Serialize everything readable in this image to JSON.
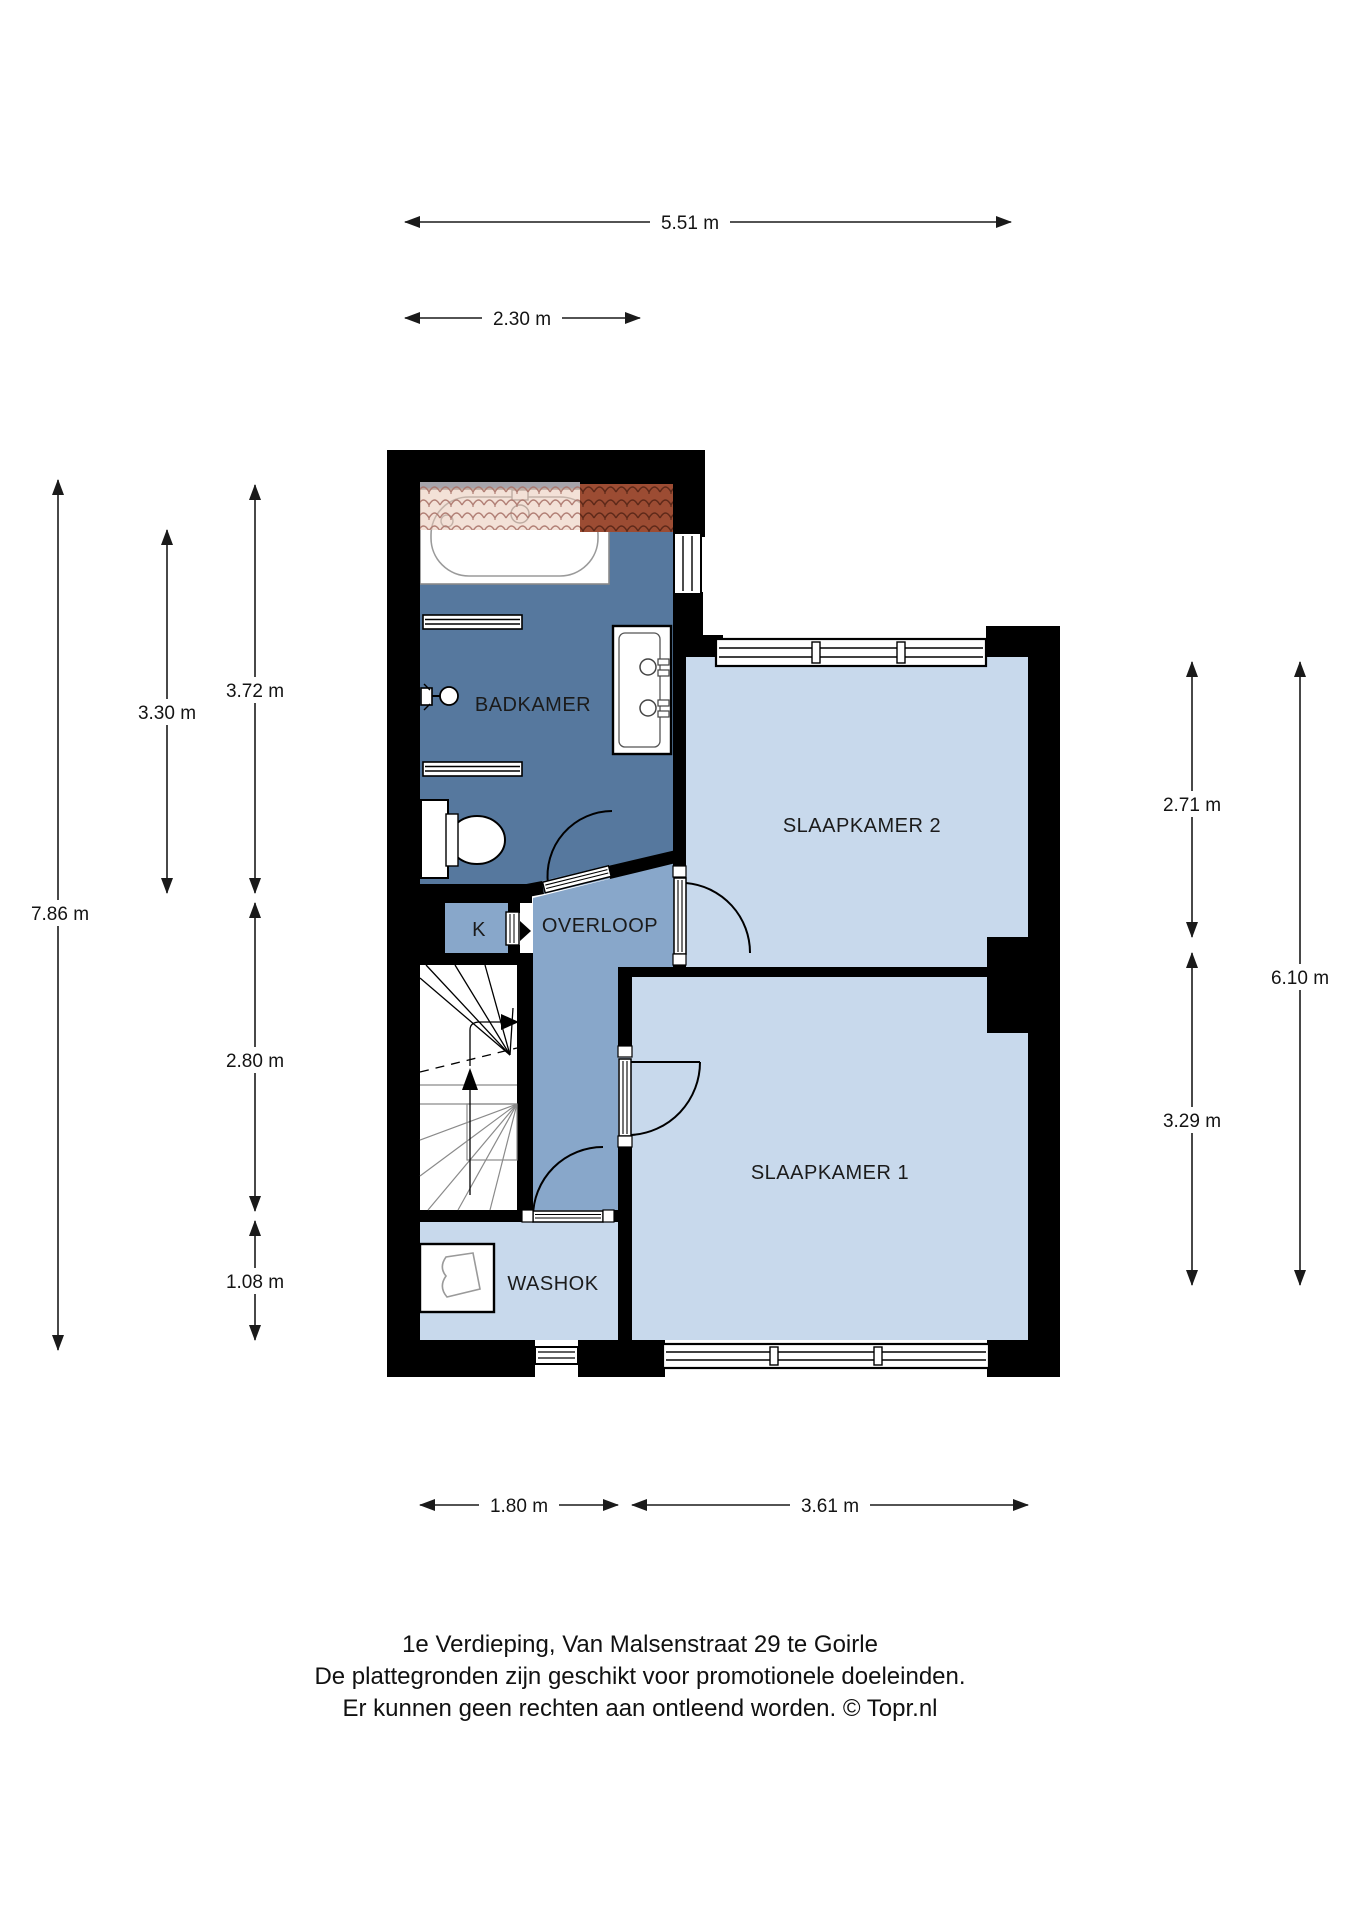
{
  "rooms": [
    {
      "id": "badkamer",
      "label": "BADKAMER"
    },
    {
      "id": "slaapkamer2",
      "label": "SLAAPKAMER 2"
    },
    {
      "id": "overloop",
      "label": "OVERLOOP"
    },
    {
      "id": "kast",
      "label": "K"
    },
    {
      "id": "slaapkamer1",
      "label": "SLAAPKAMER 1"
    },
    {
      "id": "washok",
      "label": "WASHOK"
    }
  ],
  "dimensions": [
    {
      "id": "top-total",
      "label": "5.51 m"
    },
    {
      "id": "top-badkamer",
      "label": "2.30 m"
    },
    {
      "id": "left-total",
      "label": "7.86 m"
    },
    {
      "id": "left-badkamer-inner",
      "label": "3.30 m"
    },
    {
      "id": "left-badkamer",
      "label": "3.72 m"
    },
    {
      "id": "left-trap",
      "label": "2.80 m"
    },
    {
      "id": "left-washok",
      "label": "1.08 m"
    },
    {
      "id": "right-slaapkamer2",
      "label": "2.71 m"
    },
    {
      "id": "right-slaapkamer1",
      "label": "3.29 m"
    },
    {
      "id": "right-total",
      "label": "6.10 m"
    },
    {
      "id": "bottom-washok",
      "label": "1.80 m"
    },
    {
      "id": "bottom-slaapkamer1",
      "label": "3.61 m"
    }
  ],
  "footer": {
    "line1": "1e Verdieping, Van Malsenstraat 29 te Goirle",
    "line2": "De plattegronden zijn geschikt voor promotionele doeleinden.",
    "line3": "Er kunnen geen rechten aan ontleend worden. © Topr.nl"
  },
  "colors": {
    "bathroom_floor": "#56789e",
    "landing_floor": "#88a7ca",
    "bedroom_floor": "#c8d9ec",
    "laundry_floor": "#c8d9ec",
    "wall": "#000000",
    "tile_pink": "#e9c8b6",
    "tile_brown": "#9c4c33"
  }
}
